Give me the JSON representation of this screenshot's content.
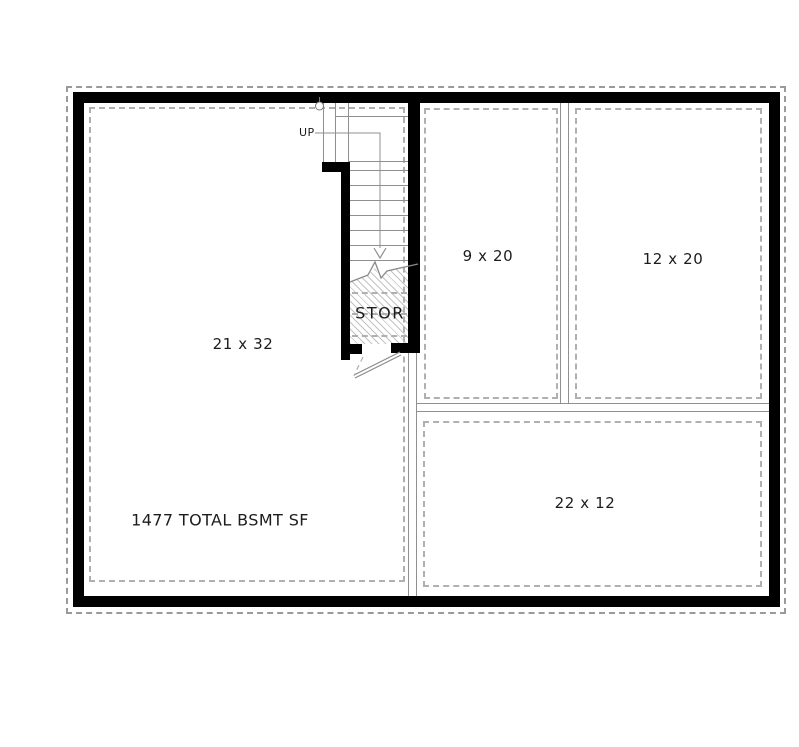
{
  "plan": {
    "name": "Basement Floor Plan",
    "total_area_label": "1477 TOTAL BSMT SF",
    "stairs": {
      "direction_label": "UP"
    },
    "rooms": [
      {
        "id": "main-room",
        "label": "21 x 32"
      },
      {
        "id": "storage-closet",
        "label": "STOR"
      },
      {
        "id": "room-upper-left",
        "label": "9 x 20"
      },
      {
        "id": "room-upper-right",
        "label": "12 x 20"
      },
      {
        "id": "room-lower",
        "label": "22 x 12"
      }
    ],
    "colors": {
      "background": "#ffffff",
      "exterior_wall": "#000000",
      "thin_line": "#8f8f8f",
      "dashed_line": "#b0b0b0",
      "hatch_line": "#919191",
      "text": "#1c1c1c"
    }
  }
}
